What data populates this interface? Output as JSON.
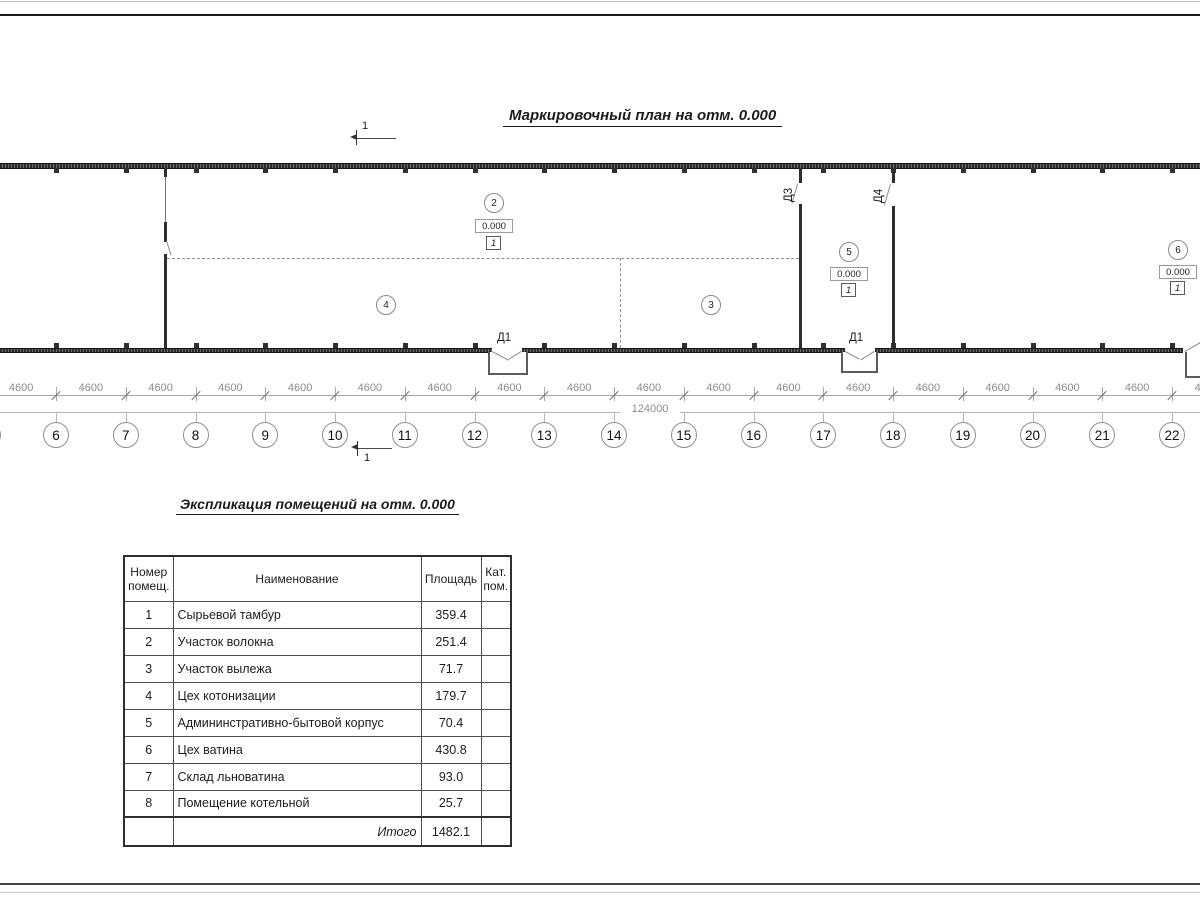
{
  "plan": {
    "title": "Маркировочный план на отм. 0.000",
    "section_label": "1",
    "door_labels": {
      "d1a": "Д1",
      "d1b": "Д1",
      "d3": "Д3",
      "d4": "Д4"
    },
    "room_markers": [
      {
        "number": "2",
        "elevation": "0.000",
        "floor": "1"
      },
      {
        "number": "3"
      },
      {
        "number": "4"
      },
      {
        "number": "5",
        "elevation": "0.000",
        "floor": "1"
      },
      {
        "number": "6",
        "elevation": "0.000",
        "floor": "1"
      }
    ],
    "axes": [
      "6",
      "7",
      "8",
      "9",
      "10",
      "11",
      "12",
      "13",
      "14",
      "15",
      "16",
      "17",
      "18",
      "19",
      "20",
      "21",
      "22"
    ],
    "dimensions": {
      "bay": "4600",
      "total": "124000"
    }
  },
  "schedule": {
    "title": "Экспликация помещений на отм. 0.000",
    "headers": {
      "number": "Номер помещ.",
      "name": "Наименование",
      "area": "Площадь",
      "category": "Кат. пом."
    },
    "rows": [
      {
        "number": "1",
        "name": "Сырьевой тамбур",
        "area": "359.4",
        "category": ""
      },
      {
        "number": "2",
        "name": "Участок волокна",
        "area": "251.4",
        "category": ""
      },
      {
        "number": "3",
        "name": "Участок вылежа",
        "area": "71.7",
        "category": ""
      },
      {
        "number": "4",
        "name": "Цех котонизации",
        "area": "179.7",
        "category": ""
      },
      {
        "number": "5",
        "name": "Админинстративно-бытовой корпус",
        "area": "70.4",
        "category": ""
      },
      {
        "number": "6",
        "name": "Цех ватина",
        "area": "430.8",
        "category": ""
      },
      {
        "number": "7",
        "name": "Склад льноватина",
        "area": "93.0",
        "category": ""
      },
      {
        "number": "8",
        "name": "Помещение котельной",
        "area": "25.7",
        "category": ""
      }
    ],
    "total_label": "Итого",
    "total_value": "1482.1"
  }
}
